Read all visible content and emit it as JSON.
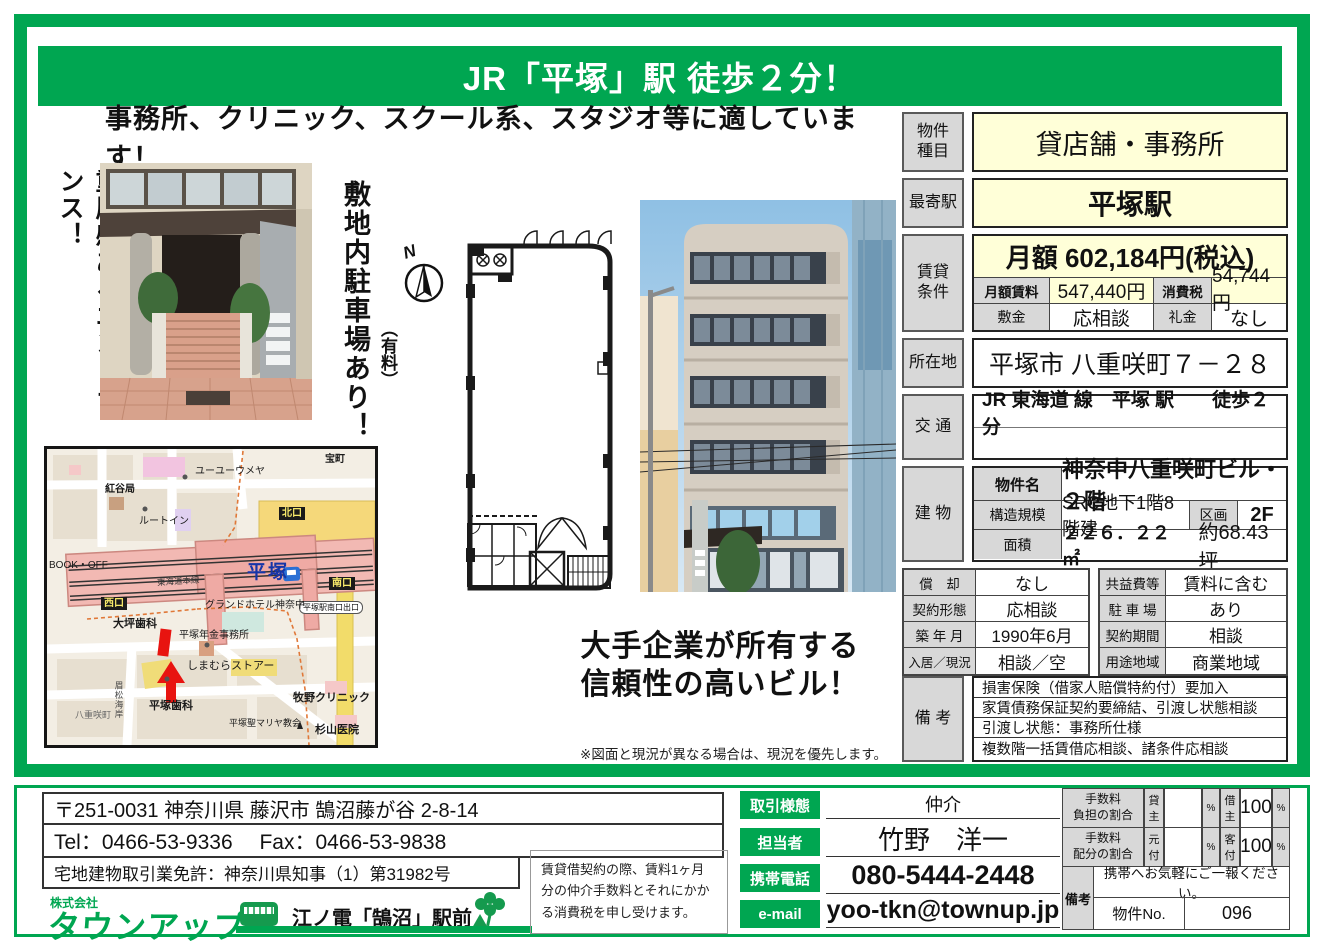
{
  "colors": {
    "green": "#00A651",
    "pale_yellow": "#FFFFD8",
    "label_gray": "#D8D8D8",
    "red": "#E8140C"
  },
  "header": {
    "title": "JR「平塚」駅 徒歩２分！",
    "subtitle": "事務所、クリニック、スクール系、スタジオ等に適しています！"
  },
  "captions": {
    "entrance_vertical": "重厚感あるエントランス！",
    "parking_vertical": "敷地内駐車場あり！",
    "parking_note": "（有料）",
    "compass_n": "N",
    "appeal_line1": "大手企業が所有する",
    "appeal_line2": "信頼性の高いビル！",
    "disclaimer": "※図面と現況が異なる場合は、現況を優先します。"
  },
  "property": {
    "type_label": "物件\n種目",
    "type_value": "貸店舗・事務所",
    "station_label": "最寄駅",
    "station_value": "平塚駅",
    "rent_label": "賃貸\n条件",
    "rent_total": "月額 602,184円(税込)",
    "rent_monthly_label": "月額賃料",
    "rent_monthly": "547,440円",
    "tax_label": "消費税",
    "tax": "54,744円",
    "deposit_label": "敷金",
    "deposit": "応相談",
    "key_money_label": "礼金",
    "key_money": "なし",
    "address_label": "所在地",
    "address": "平塚市 八重咲町７－２８",
    "access_label": "交 通",
    "access": "JR 東海道 線　平塚 駅　　徒歩２分",
    "building_label": "建 物",
    "name_label": "物件名",
    "name": "神奈中八重咲町ビル・２階",
    "structure_label": "構造規模",
    "structure": "SRC地下1階8階建",
    "section_label": "区画",
    "section": "2F",
    "area_label": "面積",
    "area_m2": "２２６．２２㎡",
    "area_tsubo": "約68.43坪",
    "details_left": [
      {
        "label": "償　却",
        "value": "なし"
      },
      {
        "label": "契約形態",
        "value": "応相談"
      },
      {
        "label": "築 年 月",
        "value": "1990年6月"
      },
      {
        "label": "入居／現況",
        "value": "相談／空"
      }
    ],
    "details_right": [
      {
        "label": "共益費等",
        "value": "賃料に含む"
      },
      {
        "label": "駐 車 場",
        "value": "あり"
      },
      {
        "label": "契約期間",
        "value": "相談"
      },
      {
        "label": "用途地域",
        "value": "商業地域"
      }
    ],
    "remarks_label": "備 考",
    "remarks": [
      "損害保険（借家人賠償特約付）要加入",
      "家賃債務保証契約要締結、引渡し状態相談",
      "引渡し状態：事務所仕様",
      "複数階一括賃借応相談、諸条件応相談"
    ]
  },
  "map": {
    "station": "平塚",
    "line": "東海道本線",
    "north_exit": "北口",
    "west_exit": "西口",
    "south_exit": "南口",
    "south_exit_sign": "平塚駅南口出口",
    "takaracho": "宝町",
    "youyou": "ユーユーウメヤ",
    "beniya": "紅谷局",
    "routeinn": "ルートイン",
    "bookoff": "BOOK・OFF",
    "otsubo_dental": "大坪歯科",
    "grand_hotel": "グランドホテル神奈中",
    "nenkin_office": "平塚年金事務所",
    "shimamura": "しまむらストアー",
    "hiratsuka_dental": "平塚歯科",
    "yaesaki": "八重咲町",
    "makino_clinic": "牧野クリニック",
    "sugiyama_clinic": "杉山医院",
    "maria_church": "平塚聖マリヤ教会",
    "coast_road": "眉松海岸"
  },
  "footer": {
    "postal_address": "〒251-0031  神奈川県 藤沢市 鵠沼藤が谷 2-8-14",
    "tel_fax": "Tel：0466-53-9336　 Fax：0466-53-9838",
    "license": "宅地建物取引業免許：神奈川県知事（1）第31982号",
    "company_prefix": "株式会社",
    "company_name": "タウンアップ",
    "location_note": "江ノ電「鵠沼」駅前",
    "fee_note": "賃貸借契約の際、賃料1ヶ月分の仲介手数料とそれにかかる消費税を申し受けます。",
    "deal_type_label": "取引様態",
    "deal_type": "仲介",
    "agent_label": "担当者",
    "agent": "竹野　洋一",
    "mobile_label": "携帯電話",
    "mobile": "080-5444-2448",
    "email_label": "e-mail",
    "email": "yoo-tkn@townup.jp",
    "fee_burden_label": "手数料\n負担の割合",
    "fee_split_label": "手数料\n配分の割合",
    "landlord": "貸主",
    "tenant": "借主",
    "motozuke": "元付",
    "kyakuzuke": "客付",
    "percent": "%",
    "tenant_share": "100",
    "kyakuzuke_share": "100",
    "remarks_label": "備考",
    "remarks_text": "携帯へお気軽にご一報ください。",
    "property_no_label": "物件No.",
    "property_no": "096"
  }
}
